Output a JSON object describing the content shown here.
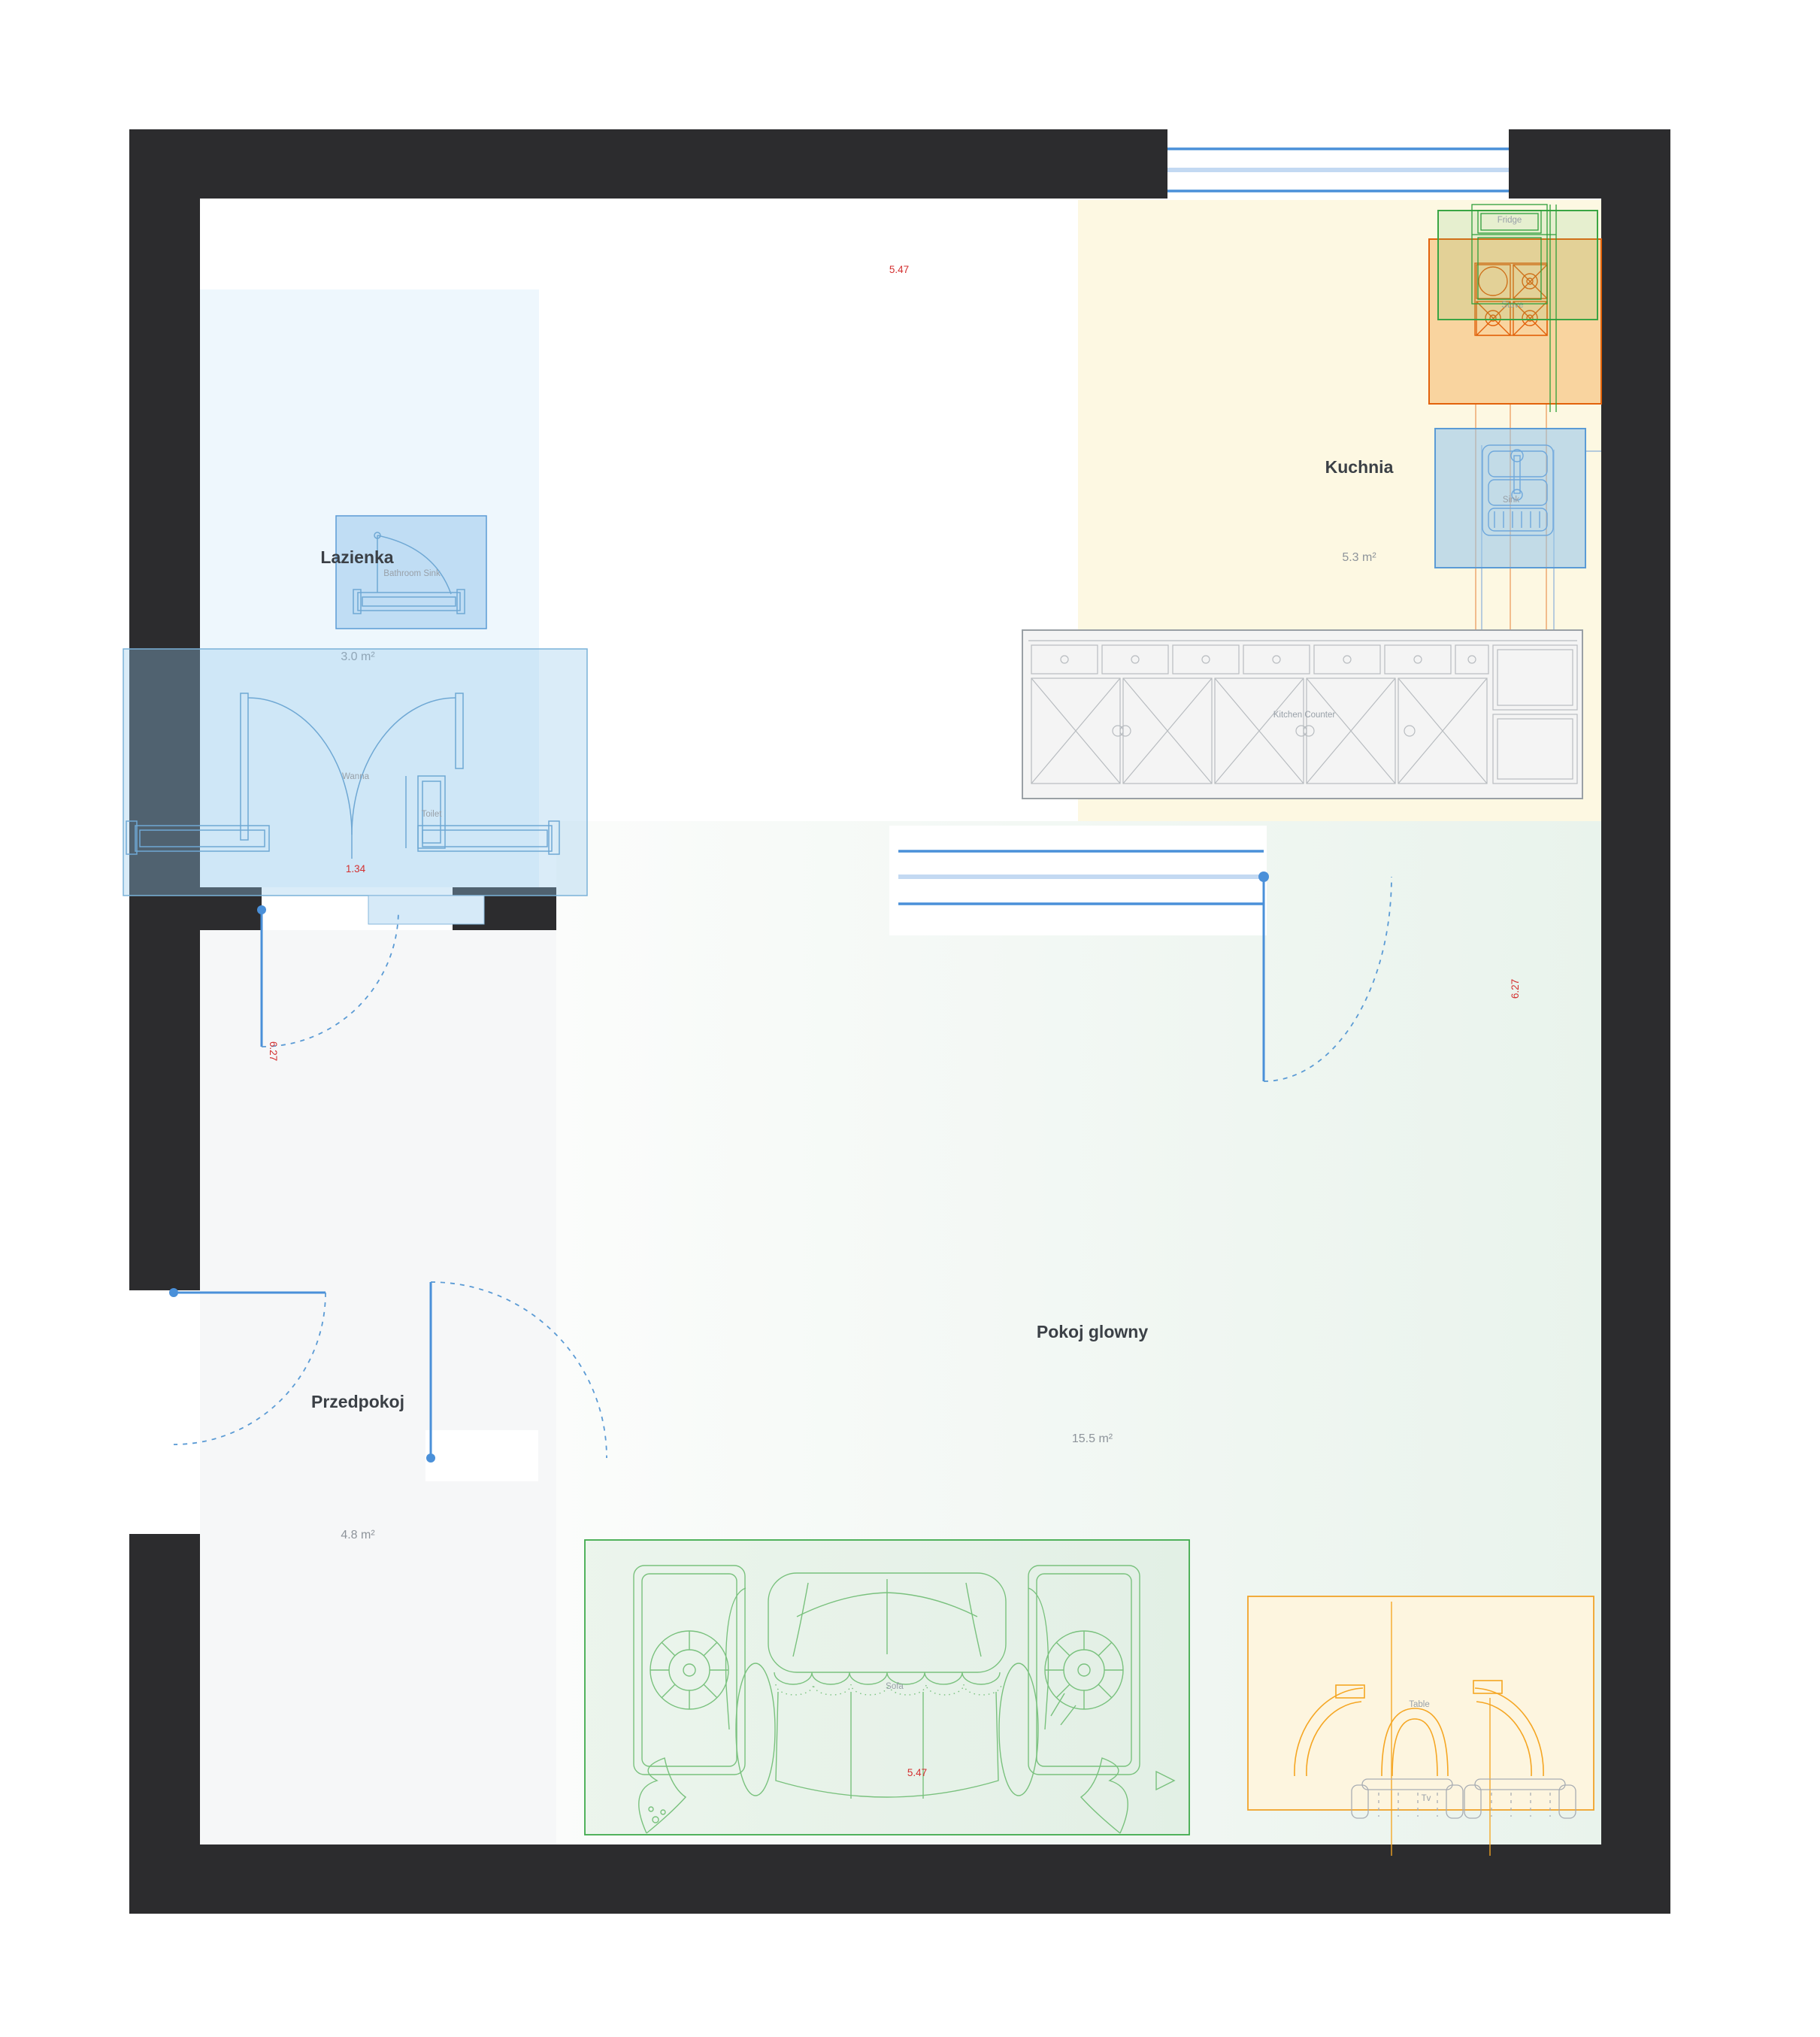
{
  "plan": {
    "rooms": {
      "bathroom": {
        "name": "Lazienka",
        "area": "3.0 m²"
      },
      "kitchen": {
        "name": "Kuchnia",
        "area": "5.3 m²"
      },
      "hallway": {
        "name": "Przedpokoj",
        "area": "4.8 m²"
      },
      "living_room": {
        "name": "Pokoj glowny",
        "area": "15.5 m²"
      }
    },
    "furniture": {
      "bathroom_sink": "Bathroom Sink",
      "bathtub": "Wanna",
      "toilet": "Toilet",
      "fridge": "Fridge",
      "stove": "Stove",
      "kitchen_sink": "Sink",
      "kitchen_counter": "Kitchen Counter",
      "sofa": "Sofa",
      "table": "Table",
      "tv": "Tv"
    },
    "dimensions": {
      "top_width": "5.47",
      "bottom_width": "5.47",
      "left_height": "6.27",
      "right_height": "6.27",
      "bathroom_width": "1.34"
    },
    "colors": {
      "wall": "#2c2c2e",
      "dimension_text": "#d32f2f",
      "door": "#4a90d9",
      "bathroom_accent": "#5b9bd5",
      "stove_zone": "#e2620b",
      "fridge_zone": "#3aa544",
      "sofa_zone": "#3faa4c",
      "table_zone": "#f0a32a"
    }
  }
}
